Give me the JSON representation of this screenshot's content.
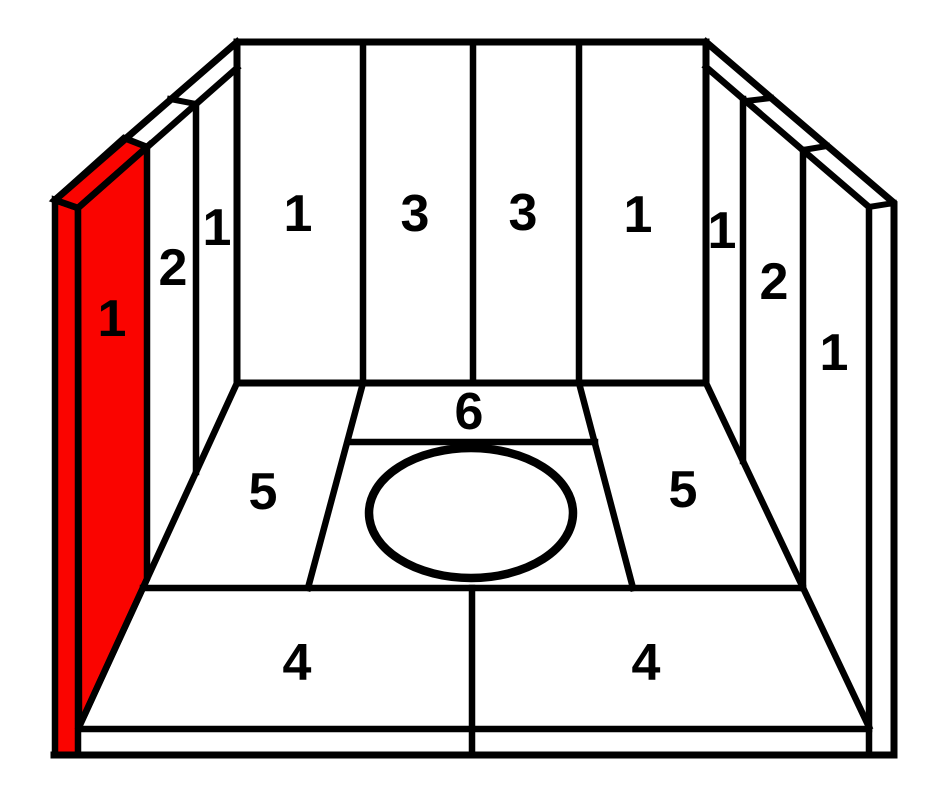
{
  "figure": {
    "kind": "firebox-brick-placement-diagram",
    "colors": {
      "background": "#ffffff",
      "line": "#000000",
      "highlight": "#fa0400"
    }
  },
  "labels": {
    "left_wall_front": "1",
    "left_wall_middle": "2",
    "left_wall_back": "1",
    "back_wall_left": "1",
    "back_wall_center_left": "3",
    "back_wall_center_right": "3",
    "back_wall_right": "1",
    "right_wall_back": "1",
    "right_wall_middle": "2",
    "right_wall_front": "1",
    "floor_back_strip": "6",
    "floor_left": "5",
    "floor_right": "5",
    "floor_front_left": "4",
    "floor_front_right": "4"
  }
}
